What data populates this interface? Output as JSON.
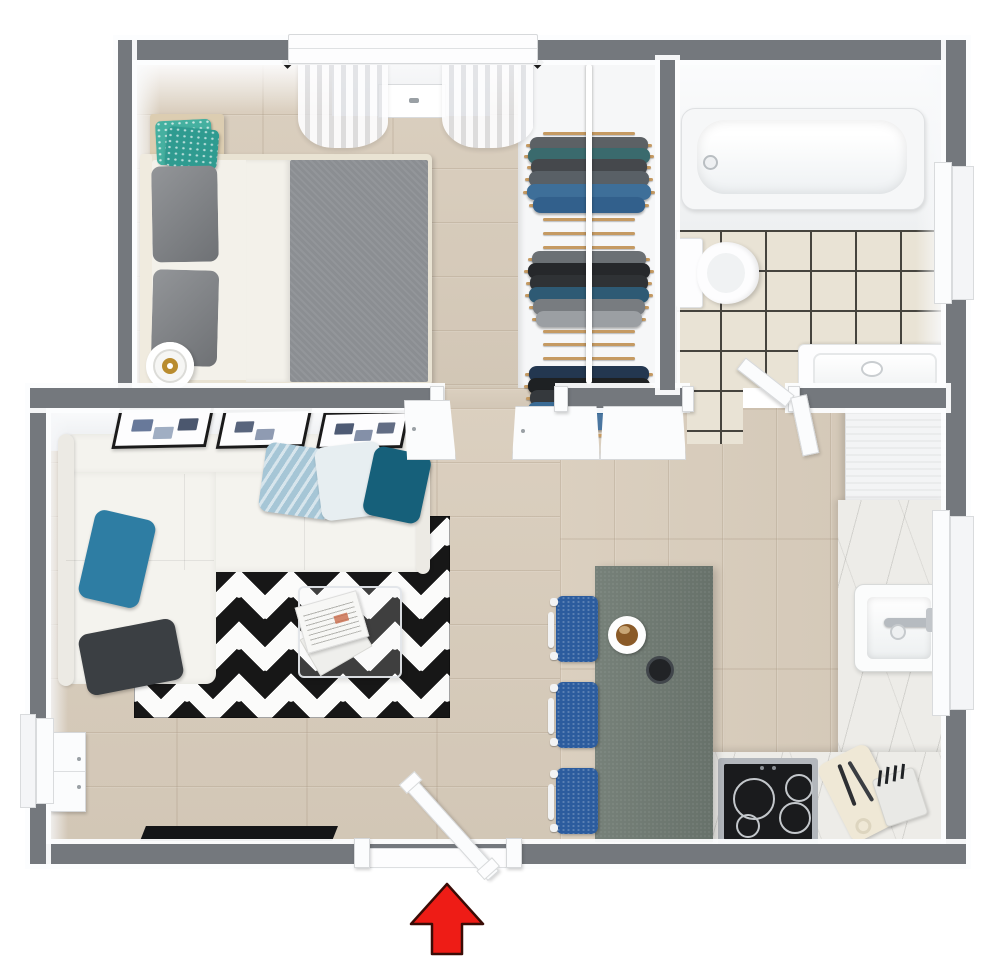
{
  "app": {
    "type": "3d-floor-plan-rendering",
    "visible_text": "none",
    "view": "top-down-3d"
  },
  "palette": {
    "wall_gray": "#74787d",
    "wood_floor": "#d9cdbc",
    "wood_seam": "rgba(143,120,92,0.30)",
    "tile_floor": "#e9e3d5",
    "tile_grout": "#46443e",
    "closet_white": "#f6f7f8",
    "hanger_wood": "#c59a62",
    "rug_black": "#171717",
    "rug_white": "#fbfbfa",
    "sofa_white": "#f4f3ee",
    "pillow_light_blue": "#a6c6d6",
    "pillow_pale": "#e7eef1",
    "pillow_dark_teal": "#16607a",
    "pillow_teal": "#2e7da3",
    "pillow_charcoal": "#3b3f43",
    "bed_frame": "#e9e3d3",
    "bed_sheet": "#f3f1ea",
    "bed_blanket": "#8b8e92",
    "bed_pillow_gray": "#7b7e82",
    "nightstand_wood": "#dccdb1",
    "cushion_teal": "#45b0a0",
    "lamp_gold": "#b98c2f",
    "table_green_gray": "#6f7a72",
    "chair_blue": "#2c5c9e",
    "marble_counter": "#edece8",
    "stove_black": "#1a1b1d",
    "burner_ring": "#c3c7cb",
    "cutting_board": "#efe8d6",
    "tub_white": "#f6f7f8",
    "porcelain": "#fdfdfe",
    "window_frame": "#f4f5f6",
    "door_white": "#fbfcfd",
    "tv_black": "#141517",
    "arrow_red": "#ee1c16",
    "arrow_outline": "#3a0c06",
    "curtain_rod": "#1b1b1b"
  },
  "rooms": [
    {
      "id": "bedroom",
      "furniture": [
        "double-bed",
        "nightstand",
        "teal-cushions",
        "table-lamp",
        "sheer-curtains",
        "window"
      ]
    },
    {
      "id": "closet",
      "furniture": [
        "clothes-rack",
        "closet-doors"
      ]
    },
    {
      "id": "bathroom",
      "furniture": [
        "bathtub",
        "toilet",
        "vanity-sink",
        "window",
        "bathroom-door"
      ]
    },
    {
      "id": "living-room",
      "furniture": [
        "sectional-sofa",
        "throw-pillows",
        "ikat-rug",
        "glass-coffee-table",
        "newspaper",
        "wall-art-frames",
        "tv",
        "sideboard",
        "window"
      ]
    },
    {
      "id": "kitchen-dining",
      "furniture": [
        "dining-table",
        "dining-chairs",
        "coffee-cup",
        "kitchen-counters",
        "kitchen-sink",
        "cooktop",
        "cutting-board",
        "knife-block",
        "tall-cabinet",
        "window"
      ]
    },
    {
      "id": "entrance",
      "furniture": [
        "entry-door",
        "direction-arrow"
      ]
    }
  ],
  "closet_rack": {
    "items": [
      {
        "y": 72,
        "kind": "hanger"
      },
      {
        "y": 84,
        "kind": "garment",
        "color": "#5c6165",
        "w": 118
      },
      {
        "y": 95,
        "kind": "garment",
        "color": "#3a6a6d",
        "w": 122,
        "pattern": true
      },
      {
        "y": 106,
        "kind": "garment",
        "color": "#45484c",
        "w": 116
      },
      {
        "y": 118,
        "kind": "garment",
        "color": "#596066",
        "w": 120
      },
      {
        "y": 131,
        "kind": "garment",
        "color": "#3e6f99",
        "w": 124,
        "pattern": true
      },
      {
        "y": 144,
        "kind": "garment",
        "color": "#32608c",
        "w": 112
      },
      {
        "y": 158,
        "kind": "hanger"
      },
      {
        "y": 172,
        "kind": "hanger"
      },
      {
        "y": 186,
        "kind": "hanger"
      },
      {
        "y": 198,
        "kind": "garment",
        "color": "#6b7074",
        "w": 114
      },
      {
        "y": 210,
        "kind": "garment",
        "color": "#26282b",
        "w": 122
      },
      {
        "y": 222,
        "kind": "garment",
        "color": "#2f3235",
        "w": 118
      },
      {
        "y": 234,
        "kind": "garment",
        "color": "#2e5a74",
        "w": 120,
        "pattern": true
      },
      {
        "y": 246,
        "kind": "garment",
        "color": "#787c80",
        "w": 112
      },
      {
        "y": 258,
        "kind": "garment",
        "color": "#9b9fa3",
        "w": 106
      },
      {
        "y": 270,
        "kind": "hanger"
      },
      {
        "y": 283,
        "kind": "hanger"
      },
      {
        "y": 297,
        "kind": "hanger"
      },
      {
        "y": 313,
        "kind": "garment",
        "color": "#233750",
        "w": 120
      },
      {
        "y": 325,
        "kind": "garment",
        "color": "#1e2123",
        "w": 122
      },
      {
        "y": 337,
        "kind": "garment",
        "color": "#35393d",
        "w": 118
      },
      {
        "y": 349,
        "kind": "garment",
        "color": "#3a6b95",
        "w": 122,
        "pattern": true
      },
      {
        "y": 361,
        "kind": "garment",
        "color": "#4a76a0",
        "w": 112
      },
      {
        "y": 374,
        "kind": "hanger"
      }
    ]
  },
  "stove_burners": [
    {
      "x": 752,
      "y": 797,
      "d": 38
    },
    {
      "x": 797,
      "y": 786,
      "d": 24
    },
    {
      "x": 746,
      "y": 824,
      "d": 20
    },
    {
      "x": 793,
      "y": 816,
      "d": 28
    }
  ],
  "dining_chairs": {
    "count": 3,
    "ys": [
      596,
      682,
      768
    ]
  },
  "wall_frames": [
    {
      "x": 116,
      "y": 406,
      "w": 88,
      "h": 36,
      "art": [
        "#4e6288",
        "#8fa0b8",
        "#2c3a55"
      ]
    },
    {
      "x": 220,
      "y": 409,
      "w": 82,
      "h": 33,
      "art": [
        "#3c4a66",
        "#7b89a4"
      ]
    },
    {
      "x": 320,
      "y": 411,
      "w": 80,
      "h": 32,
      "art": [
        "#2f3e5c",
        "#6f7d99",
        "#46536e"
      ]
    }
  ],
  "entrance_arrow": {
    "direction": "up",
    "points": "447,884 483,924 462,924 462,954 432,954 432,924 411,924"
  }
}
